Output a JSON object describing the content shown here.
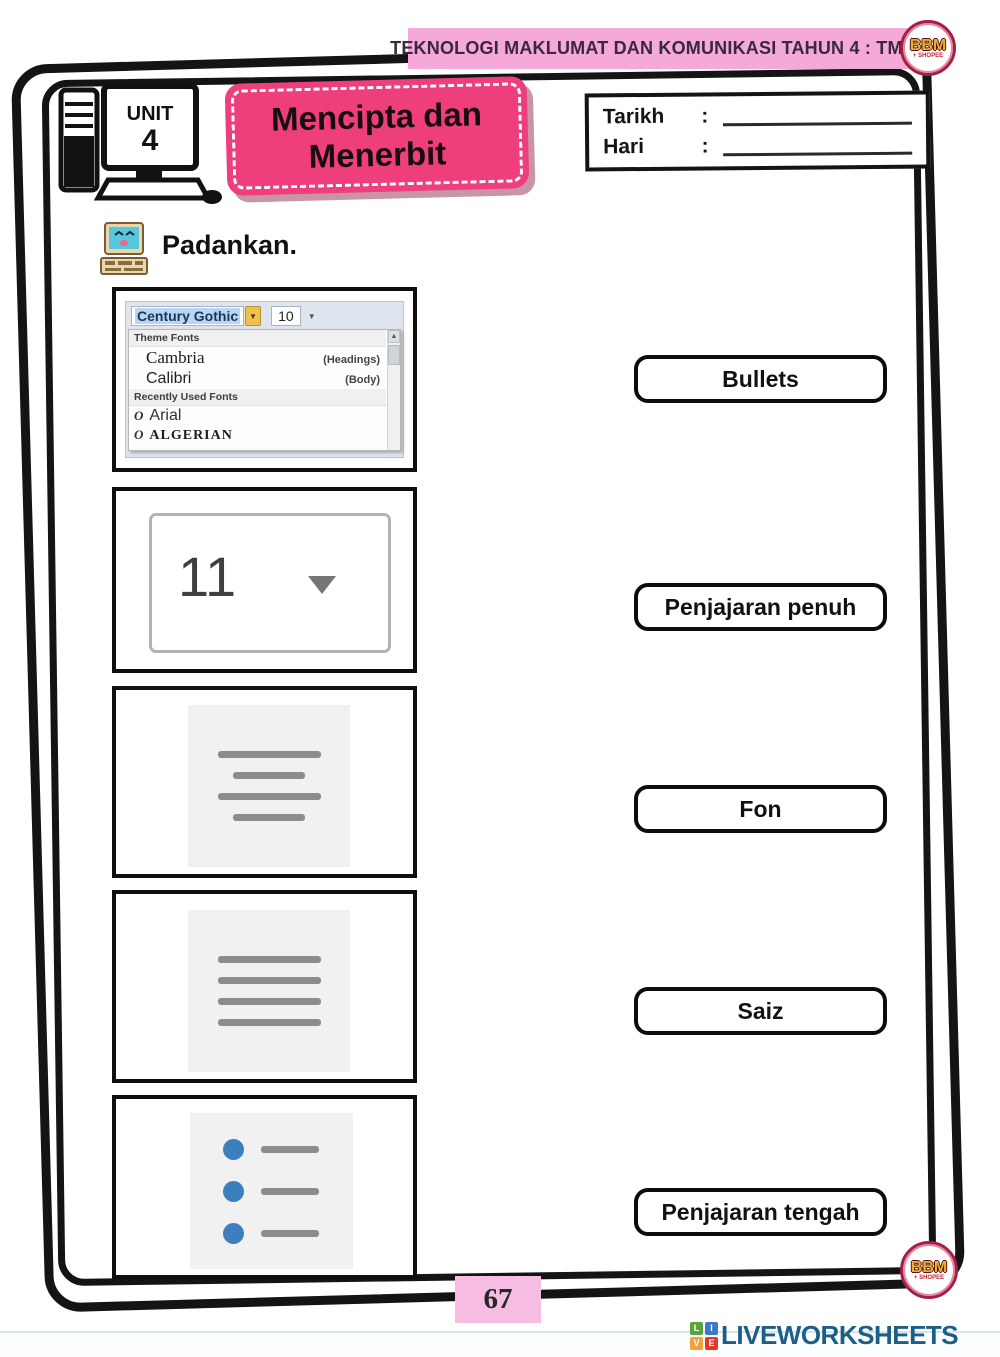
{
  "header": {
    "banner_title": "TEKNOLOGI MAKLUMAT DAN KOMUNIKASI TAHUN 4 : TMK",
    "unit_label": "UNIT",
    "unit_number": "4",
    "title_line1": "Mencipta dan",
    "title_line2": "Menerbit",
    "date_label": "Tarikh",
    "date_colon": ":",
    "day_label": "Hari",
    "day_colon": ":"
  },
  "badges": {
    "bbm_text": "BBM",
    "bbm_sub": "+ SHOPEE"
  },
  "instruction": "Padankan.",
  "font_menu": {
    "selected_font": "Century Gothic",
    "selected_size": "10",
    "arrow_down": "▼",
    "theme_header": "Theme Fonts",
    "items": [
      {
        "name": "Cambria",
        "tag": "(Headings)"
      },
      {
        "name": "Calibri",
        "tag": "(Body)"
      }
    ],
    "recent_header": "Recently Used Fonts",
    "recent_items": [
      "Arial",
      "ALGERIAN"
    ],
    "tt_glyph": "O",
    "scroll_up_glyph": "▲"
  },
  "size_control": {
    "value": "11"
  },
  "labels": {
    "bullets": "Bullets",
    "justify": "Penjajaran penuh",
    "font": "Fon",
    "size": "Saiz",
    "center": "Penjajaran tengah"
  },
  "footer": {
    "page_number": "67",
    "brand": "LIVEWORKSHEETS",
    "brand_squares": [
      "L",
      "I",
      "V",
      "E"
    ]
  },
  "colors": {
    "banner_pink": "#f4a9d8",
    "title_pink": "#ee3e7c",
    "bullet_blue": "#3d7ebd",
    "line_gray": "#8c8c8c",
    "brand_blue": "#1d5e86"
  }
}
